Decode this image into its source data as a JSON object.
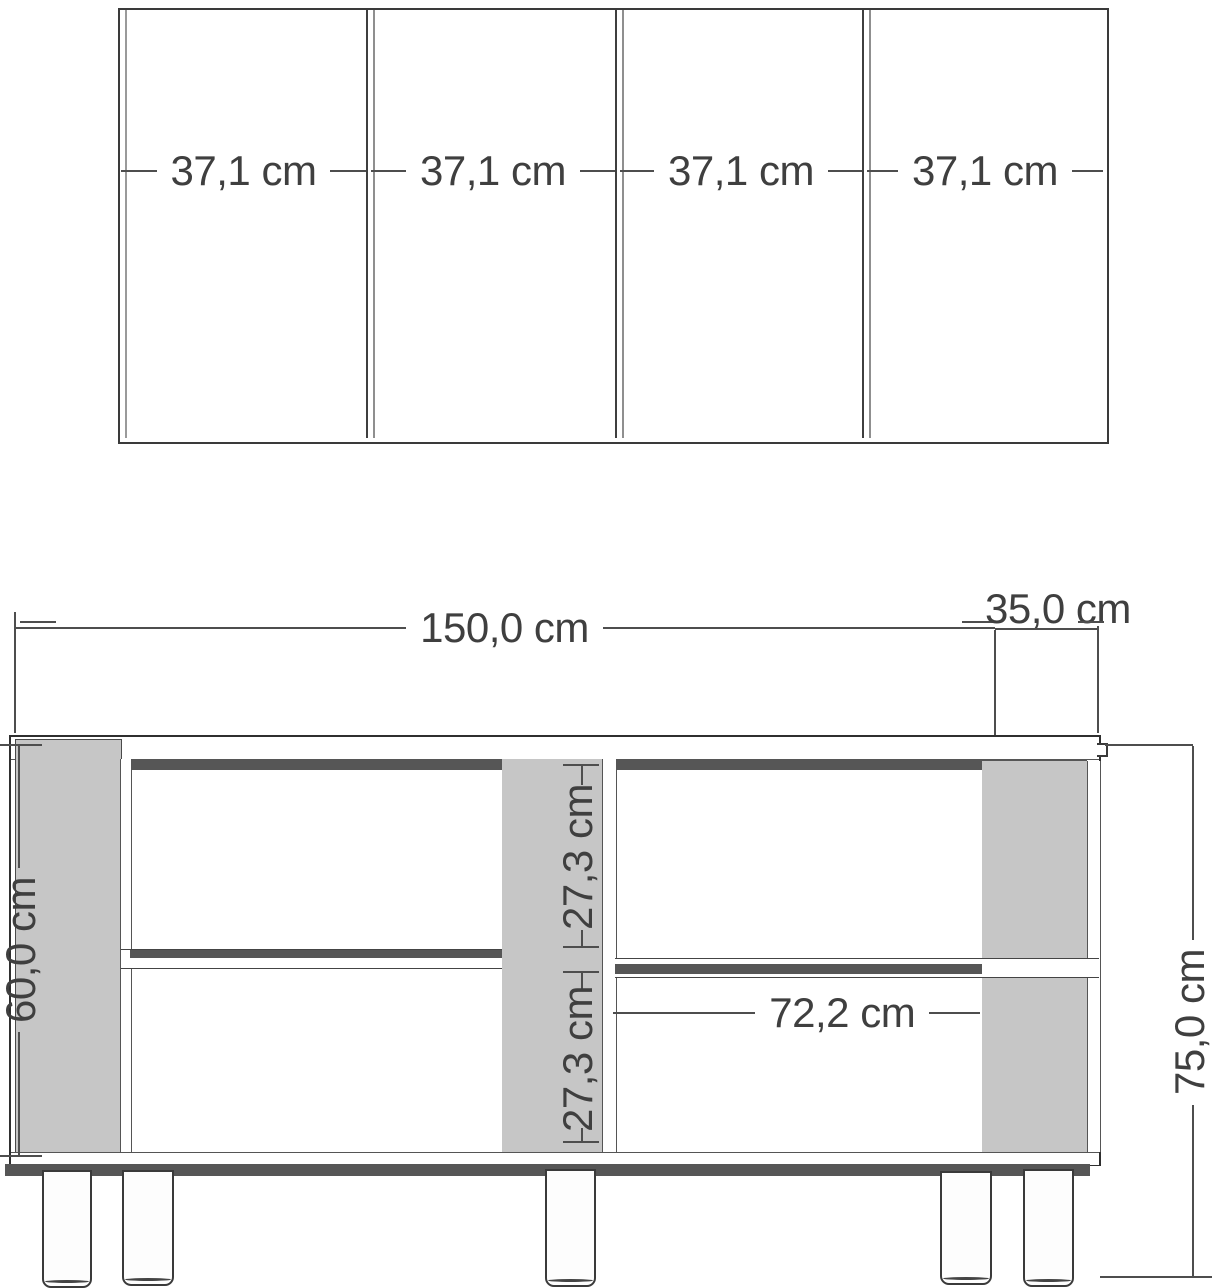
{
  "colors": {
    "background": "#ffffff",
    "panel_gray": "#c6c6c6",
    "shadow_gray": "#565656",
    "line": "#3a3a3a",
    "text": "#3f3f3f"
  },
  "top_view": {
    "panel_labels": [
      "37,1 cm",
      "37,1 cm",
      "37,1 cm",
      "37,1 cm"
    ]
  },
  "front_view": {
    "overall_width": "150,0 cm",
    "depth": "35,0 cm",
    "body_height": "60,0 cm",
    "shelf_upper": "27,3 cm",
    "shelf_lower": "27,3 cm",
    "inner_width": "72,2 cm",
    "total_height": "75,0 cm"
  }
}
